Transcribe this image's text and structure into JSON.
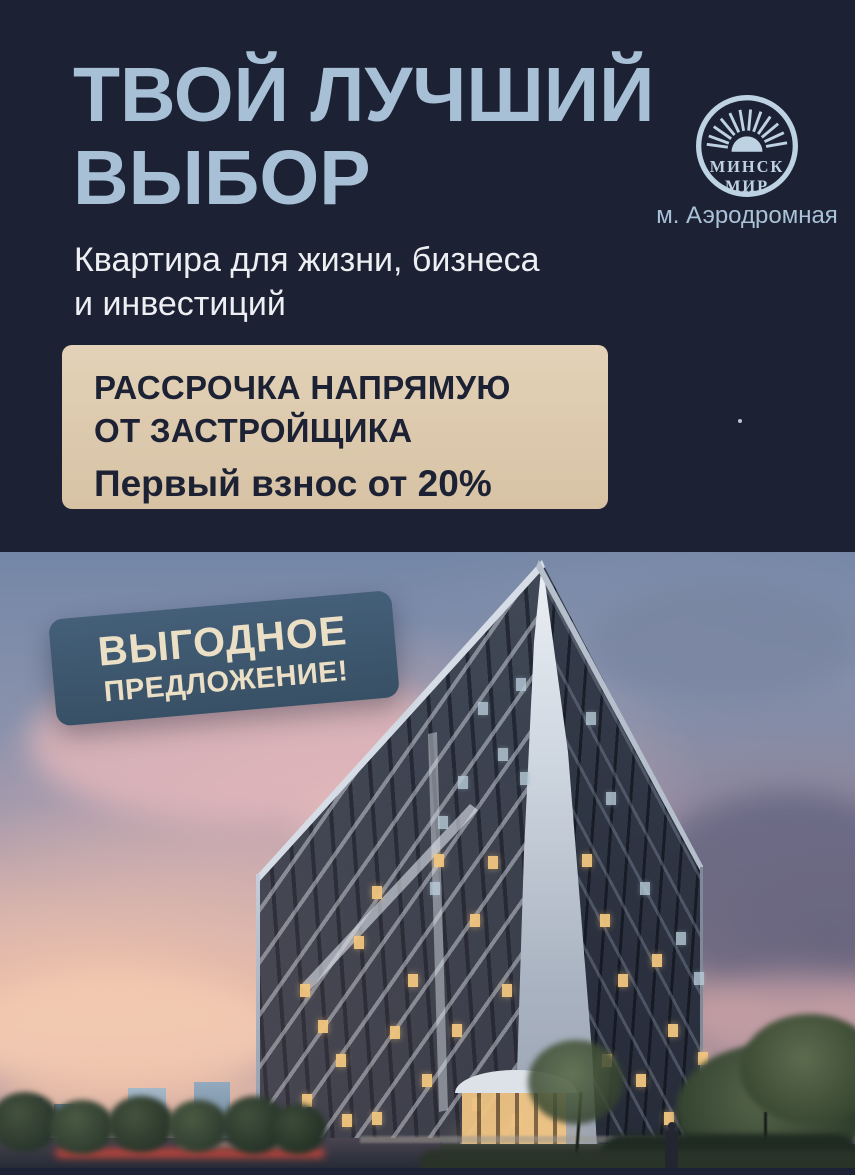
{
  "poster": {
    "title": {
      "line1": "ТВОЙ ЛУЧШИЙ",
      "line2": "ВЫБОР"
    },
    "subtitle": {
      "line1": "Квартира для жизни, бизнеса",
      "line2": "и инвестиций"
    },
    "logo": {
      "line1": "МИНСК",
      "line2": "МИР",
      "metro": "м. Аэродромная"
    },
    "offer": {
      "line1": "РАССРОЧКА НАПРЯМУЮ",
      "line2": "ОТ ЗАСТРОЙЩИКА",
      "line3": "Первый взнос от 20%"
    },
    "badge": {
      "line1": "ВЫГОДНОЕ",
      "line2": "ПРЕДЛОЖЕНИЕ!"
    },
    "colors": {
      "background": "#1c2134",
      "title": "#a7c0d6",
      "subtitle": "#edeff3",
      "offer_bg": "#ddc9ac",
      "offer_text": "#1c2134",
      "badge_bg": "#3e5b74",
      "badge_text": "#ebdfc6",
      "logo": "#bdd2e2",
      "sky_pink": "#dbb0a9",
      "sky_blue": "#7487a7"
    }
  }
}
